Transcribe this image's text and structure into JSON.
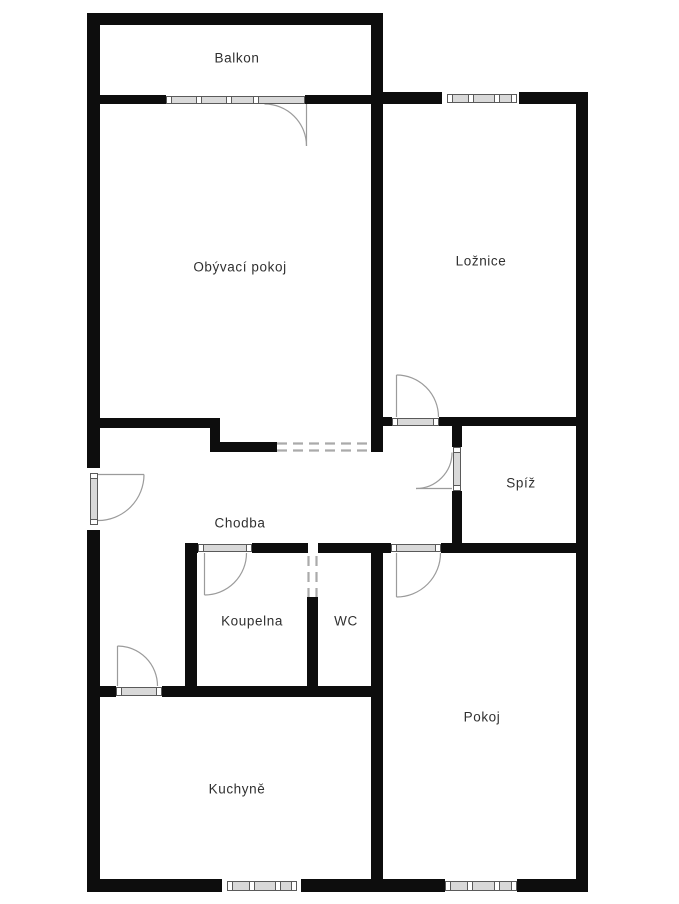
{
  "rooms": [
    {
      "name": "balkon",
      "label": "Balkon"
    },
    {
      "name": "obyvaci-pokoj",
      "label": "Obývací pokoj"
    },
    {
      "name": "loznice",
      "label": "Ložnice"
    },
    {
      "name": "spiz",
      "label": "Spíž"
    },
    {
      "name": "chodba",
      "label": "Chodba"
    },
    {
      "name": "koupelna",
      "label": "Koupelna"
    },
    {
      "name": "wc",
      "label": "WC"
    },
    {
      "name": "pokoj",
      "label": "Pokoj"
    },
    {
      "name": "kuchyne",
      "label": "Kuchyně"
    }
  ],
  "colors": {
    "wall": "#0d0d0d",
    "bg": "#ffffff",
    "text": "#303030",
    "door": "#9b9b9b",
    "window-fill": "#d9d9d9",
    "window-border": "#5a5a5a",
    "dash": "#aaaaaa"
  }
}
